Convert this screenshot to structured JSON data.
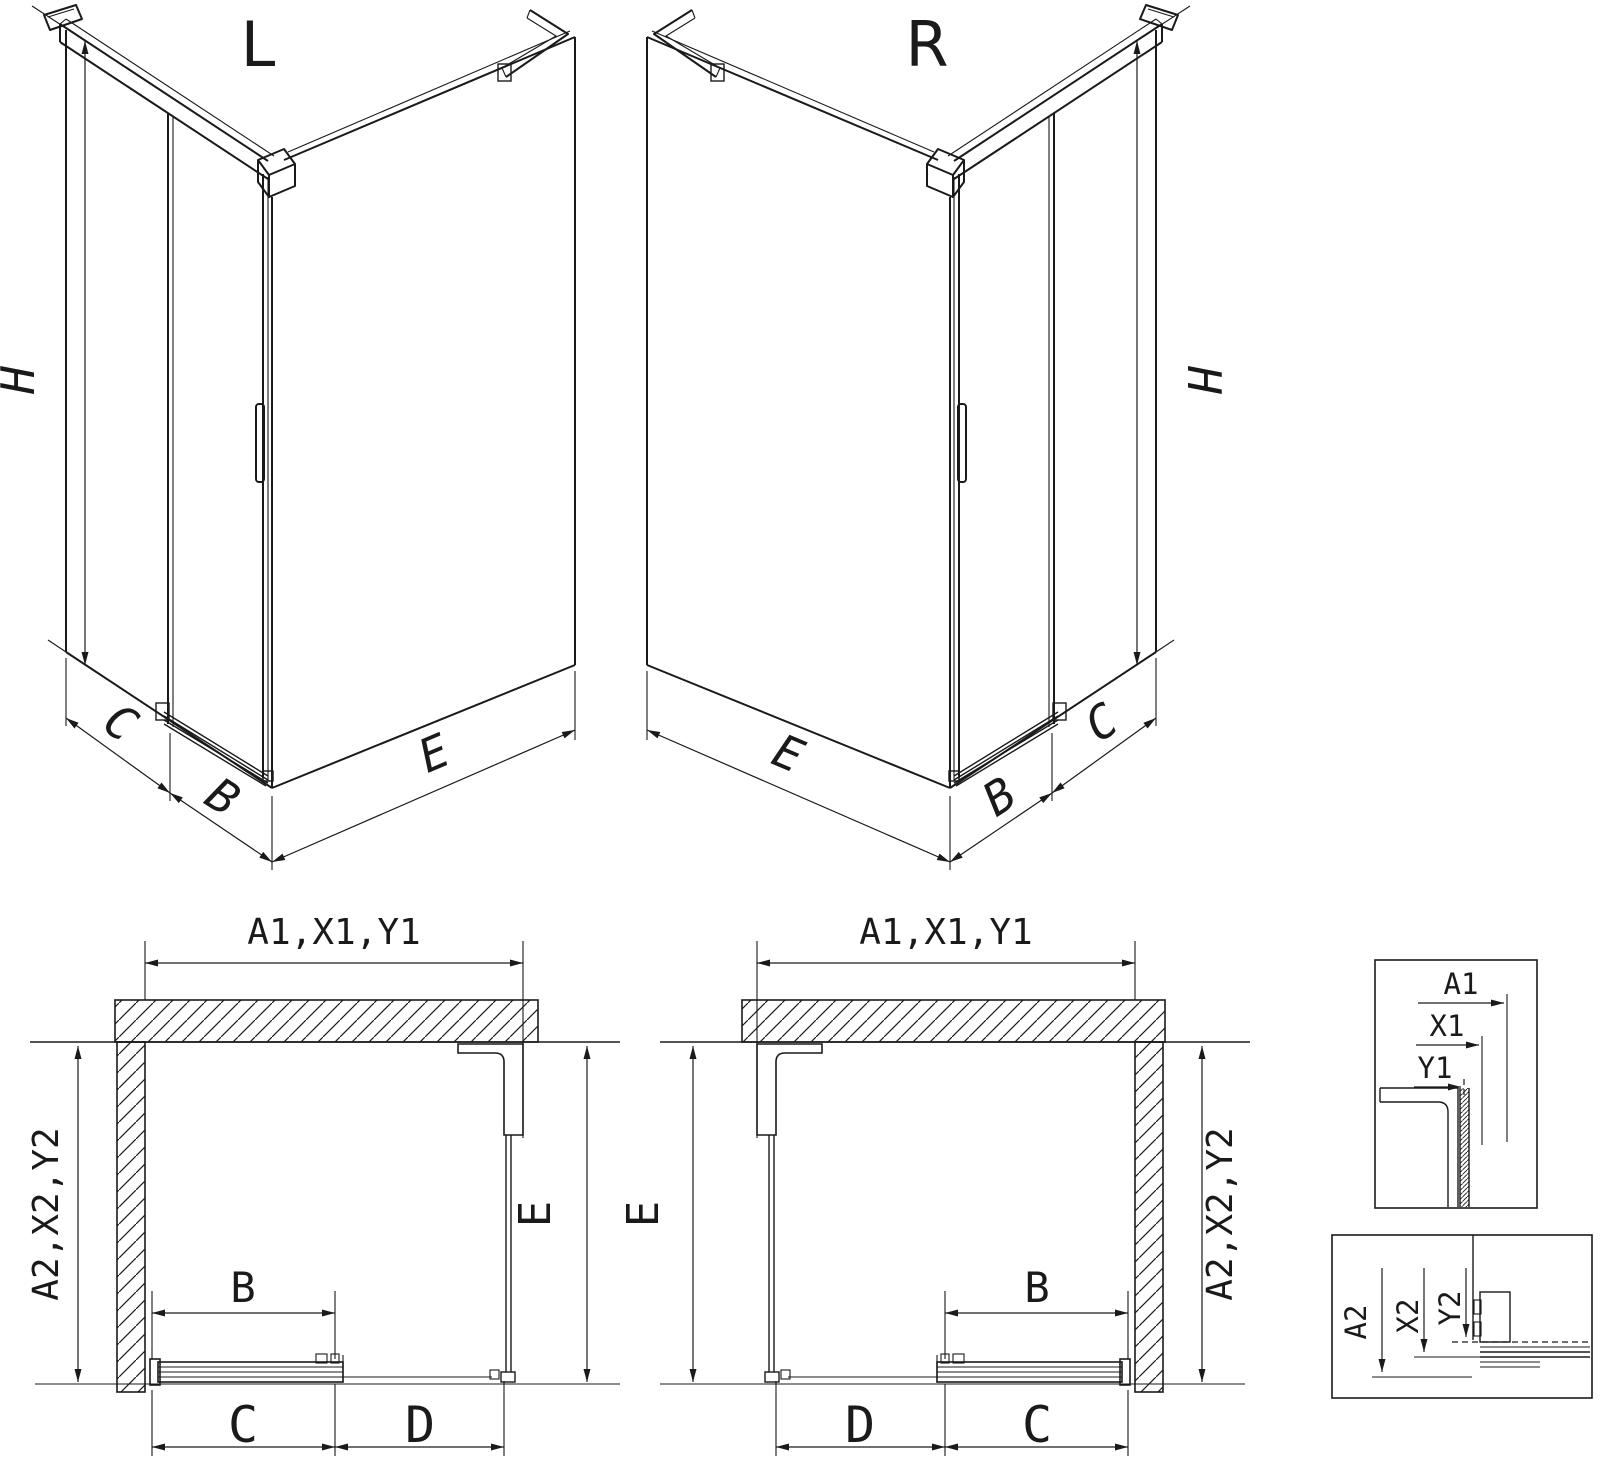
{
  "titles": {
    "left_view": "L",
    "right_view": "R"
  },
  "iso_left": {
    "height": "H",
    "left": "C",
    "door": "B",
    "side": "E"
  },
  "iso_right": {
    "height": "H",
    "side": "E",
    "door": "B",
    "right": "C"
  },
  "plan_left": {
    "top": "A1,X1,Y1",
    "left": "A2,X2,Y2",
    "side": "E",
    "door": "B",
    "bottom_left": "C",
    "bottom_right": "D"
  },
  "plan_right": {
    "top": "A1,X1,Y1",
    "right": "A2,X2,Y2",
    "side": "E",
    "door": "B",
    "bottom_left": "D",
    "bottom_right": "C"
  },
  "detail_top": {
    "a": "A1",
    "x": "X1",
    "y": "Y1"
  },
  "detail_bottom": {
    "a": "A2",
    "x": "X2",
    "y": "Y2"
  },
  "colors": {
    "line": "#1a1a1a",
    "background": "#ffffff"
  }
}
